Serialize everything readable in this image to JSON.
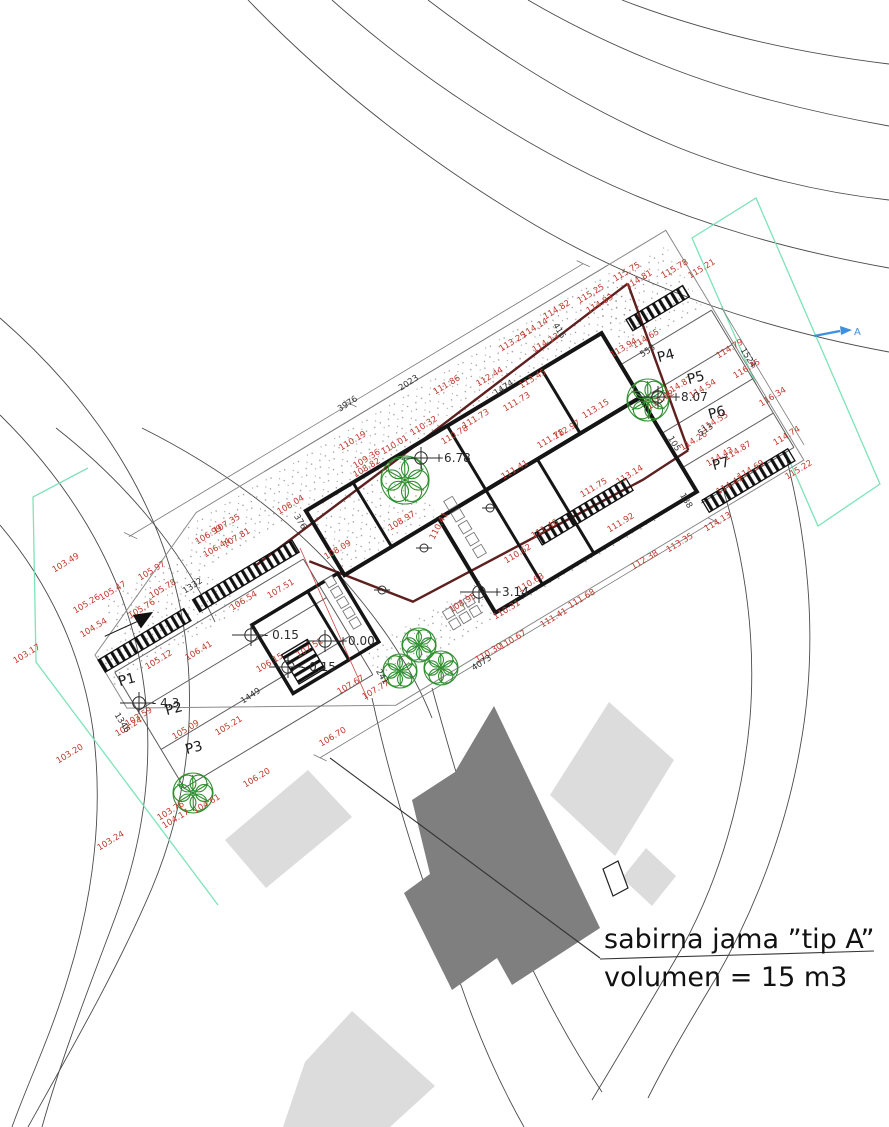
{
  "title": {
    "line1": "sabirna jama ”tip A”",
    "line2": "volumen = 15 m3"
  },
  "section_marker": {
    "label": "A"
  },
  "colors": {
    "elevation_red": "#c0392b",
    "boundary_maroon": "#5e1f1f",
    "parcel_mint": "#7de3b8",
    "section_blue": "#3f8fe0",
    "building_dark": "#7f7f7f",
    "building_light": "#dcdcdc",
    "tree_green": "#2f8f2f"
  },
  "p_labels": [
    {
      "t": "P1",
      "x": 128,
      "y": 684
    },
    {
      "t": "P2",
      "x": 175,
      "y": 713
    },
    {
      "t": "P3",
      "x": 195,
      "y": 752
    },
    {
      "t": "P4",
      "x": 667,
      "y": 360
    },
    {
      "t": "P5",
      "x": 697,
      "y": 382
    },
    {
      "t": "P6",
      "x": 718,
      "y": 417
    },
    {
      "t": "P7",
      "x": 722,
      "y": 468
    }
  ],
  "level_markers": [
    {
      "label": "+0.00",
      "x": 338,
      "y": 645
    },
    {
      "label": "- 0.15",
      "x": 264,
      "y": 639
    },
    {
      "label": "- 0.15",
      "x": 301,
      "y": 671
    },
    {
      "label": "+3.14",
      "x": 492,
      "y": 596
    },
    {
      "label": "+6.78",
      "x": 434,
      "y": 462
    },
    {
      "label": "+8.07",
      "x": 671,
      "y": 401
    },
    {
      "label": "- 4.3",
      "x": 152,
      "y": 707
    }
  ],
  "elevation_labels": [
    {
      "t": "115.75",
      "x": 628,
      "y": 274
    },
    {
      "t": "114.81",
      "x": 640,
      "y": 282
    },
    {
      "t": "115.78",
      "x": 676,
      "y": 271
    },
    {
      "t": "115.21",
      "x": 703,
      "y": 271
    },
    {
      "t": "115.25",
      "x": 592,
      "y": 296
    },
    {
      "t": "114.83",
      "x": 601,
      "y": 306
    },
    {
      "t": "114.82",
      "x": 558,
      "y": 312
    },
    {
      "t": "114.14",
      "x": 536,
      "y": 330
    },
    {
      "t": "113.25",
      "x": 514,
      "y": 344
    },
    {
      "t": "114.13",
      "x": 547,
      "y": 345
    },
    {
      "t": "112.44",
      "x": 491,
      "y": 379
    },
    {
      "t": "113.45",
      "x": 534,
      "y": 381
    },
    {
      "t": "111.86",
      "x": 448,
      "y": 387
    },
    {
      "t": "111.73",
      "x": 518,
      "y": 404
    },
    {
      "t": "111.73",
      "x": 477,
      "y": 421
    },
    {
      "t": "110.78",
      "x": 456,
      "y": 437
    },
    {
      "t": "110.32",
      "x": 425,
      "y": 428
    },
    {
      "t": "113.15",
      "x": 597,
      "y": 411
    },
    {
      "t": "112.97",
      "x": 568,
      "y": 432
    },
    {
      "t": "111.78",
      "x": 552,
      "y": 441
    },
    {
      "t": "110.19",
      "x": 354,
      "y": 443
    },
    {
      "t": "110.01",
      "x": 396,
      "y": 447
    },
    {
      "t": "109.36",
      "x": 368,
      "y": 461
    },
    {
      "t": "108.82",
      "x": 368,
      "y": 470
    },
    {
      "t": "111.41",
      "x": 516,
      "y": 472
    },
    {
      "t": "111.75",
      "x": 595,
      "y": 490
    },
    {
      "t": "108.97",
      "x": 403,
      "y": 523
    },
    {
      "t": "110.41",
      "x": 441,
      "y": 527,
      "r": -62
    },
    {
      "t": "111.46",
      "x": 546,
      "y": 531
    },
    {
      "t": "108.09",
      "x": 339,
      "y": 552
    },
    {
      "t": "110.62",
      "x": 519,
      "y": 556
    },
    {
      "t": "110.63",
      "x": 532,
      "y": 585
    },
    {
      "t": "108.95",
      "x": 464,
      "y": 605
    },
    {
      "t": "110.31",
      "x": 508,
      "y": 612
    },
    {
      "t": "111.68",
      "x": 583,
      "y": 601
    },
    {
      "t": "111.41",
      "x": 555,
      "y": 620
    },
    {
      "t": "110.67",
      "x": 514,
      "y": 642
    },
    {
      "t": "110.30",
      "x": 490,
      "y": 655
    },
    {
      "t": "113.94",
      "x": 625,
      "y": 350
    },
    {
      "t": "114.65",
      "x": 647,
      "y": 341
    },
    {
      "t": "113.62",
      "x": 662,
      "y": 402
    },
    {
      "t": "114.87",
      "x": 680,
      "y": 388
    },
    {
      "t": "114.54",
      "x": 704,
      "y": 391
    },
    {
      "t": "114.55",
      "x": 716,
      "y": 424
    },
    {
      "t": "114.26",
      "x": 695,
      "y": 443
    },
    {
      "t": "114.87",
      "x": 739,
      "y": 453
    },
    {
      "t": "114.43",
      "x": 721,
      "y": 459
    },
    {
      "t": "114.69",
      "x": 752,
      "y": 472
    },
    {
      "t": "114.41",
      "x": 731,
      "y": 487
    },
    {
      "t": "114.13",
      "x": 719,
      "y": 524
    },
    {
      "t": "114.79",
      "x": 731,
      "y": 351
    },
    {
      "t": "116.35",
      "x": 748,
      "y": 371
    },
    {
      "t": "116.34",
      "x": 774,
      "y": 399
    },
    {
      "t": "114.74",
      "x": 788,
      "y": 438
    },
    {
      "t": "115.22",
      "x": 800,
      "y": 472
    },
    {
      "t": "113.35",
      "x": 681,
      "y": 545
    },
    {
      "t": "112.38",
      "x": 646,
      "y": 562
    },
    {
      "t": "113.14",
      "x": 631,
      "y": 477
    },
    {
      "t": "111.92",
      "x": 622,
      "y": 525
    },
    {
      "t": "108.04",
      "x": 292,
      "y": 507
    },
    {
      "t": "107.51",
      "x": 282,
      "y": 591
    },
    {
      "t": "107.51",
      "x": 311,
      "y": 650
    },
    {
      "t": "106.54",
      "x": 245,
      "y": 603
    },
    {
      "t": "106.15",
      "x": 271,
      "y": 665
    },
    {
      "t": "106.41",
      "x": 200,
      "y": 653
    },
    {
      "t": "105.12",
      "x": 160,
      "y": 662
    },
    {
      "t": "105.97",
      "x": 153,
      "y": 573
    },
    {
      "t": "105.78",
      "x": 164,
      "y": 591
    },
    {
      "t": "105.47",
      "x": 114,
      "y": 593
    },
    {
      "t": "105.76",
      "x": 143,
      "y": 611
    },
    {
      "t": "105.26",
      "x": 88,
      "y": 606
    },
    {
      "t": "104.54",
      "x": 95,
      "y": 630
    },
    {
      "t": "103.49",
      "x": 67,
      "y": 565
    },
    {
      "t": "103.17",
      "x": 28,
      "y": 656
    },
    {
      "t": "107.35",
      "x": 228,
      "y": 526
    },
    {
      "t": "106.99",
      "x": 210,
      "y": 537
    },
    {
      "t": "107.81",
      "x": 238,
      "y": 540
    },
    {
      "t": "106.44",
      "x": 218,
      "y": 550
    },
    {
      "t": "103.59",
      "x": 140,
      "y": 719
    },
    {
      "t": "103.24",
      "x": 130,
      "y": 729
    },
    {
      "t": "105.09",
      "x": 187,
      "y": 732
    },
    {
      "t": "105.21",
      "x": 230,
      "y": 728
    },
    {
      "t": "103.20",
      "x": 71,
      "y": 756
    },
    {
      "t": "106.20",
      "x": 258,
      "y": 780
    },
    {
      "t": "104.61",
      "x": 208,
      "y": 806
    },
    {
      "t": "103.76",
      "x": 172,
      "y": 813
    },
    {
      "t": "104.17",
      "x": 177,
      "y": 821
    },
    {
      "t": "103.24",
      "x": 112,
      "y": 843
    },
    {
      "t": "107.67",
      "x": 352,
      "y": 687
    },
    {
      "t": "107.77",
      "x": 377,
      "y": 692
    },
    {
      "t": "106.70",
      "x": 334,
      "y": 739
    }
  ],
  "dimension_labels": [
    {
      "t": "3976",
      "x": 349,
      "y": 406,
      "r": -33
    },
    {
      "t": "2023",
      "x": 410,
      "y": 385,
      "r": -33
    },
    {
      "t": "1474",
      "x": 505,
      "y": 390,
      "r": -33
    },
    {
      "t": "1332",
      "x": 194,
      "y": 588,
      "r": -33
    },
    {
      "t": "1346",
      "x": 120,
      "y": 724,
      "r": 58
    },
    {
      "t": "1449",
      "x": 252,
      "y": 698,
      "r": -33
    },
    {
      "t": "4073",
      "x": 483,
      "y": 665,
      "r": -33
    },
    {
      "t": "416",
      "x": 557,
      "y": 332,
      "r": 58
    },
    {
      "t": "553",
      "x": 649,
      "y": 353,
      "r": -33
    },
    {
      "t": "513",
      "x": 707,
      "y": 432,
      "r": -33
    },
    {
      "t": "241",
      "x": 380,
      "y": 678,
      "r": 58
    },
    {
      "t": "105",
      "x": 672,
      "y": 445,
      "r": 58
    },
    {
      "t": "1524",
      "x": 746,
      "y": 359,
      "r": 58
    },
    {
      "t": "376",
      "x": 298,
      "y": 523,
      "r": 58
    },
    {
      "t": "138",
      "x": 684,
      "y": 502,
      "r": 58
    }
  ]
}
